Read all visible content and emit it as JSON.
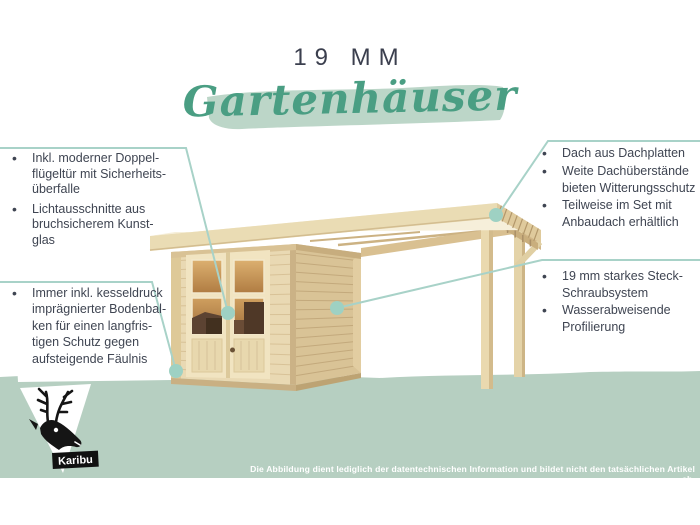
{
  "title": "19 MM",
  "headline": "Gartenhäuser",
  "logo": {
    "brand": "Karibu"
  },
  "disclaimer": "Die Abbildung dient lediglich der datentechnischen Information und bildet nicht den tatsächlichen Artikel ab.",
  "colors": {
    "headline_green": "#4a9e83",
    "brush_green": "#bcd6c8",
    "band_green": "#b6cfc1",
    "callout_line_teal": "#a8d2c8",
    "callout_dot_teal": "#9ed1c3",
    "body_text": "#3f4552",
    "title_text": "#3b3f4e",
    "wood_light": "#eadcb4",
    "wood_side": "#d9c396",
    "window_amber": "#c9965a"
  },
  "callouts": {
    "left_top": {
      "items": [
        {
          "lines": [
            "Inkl. moderner Doppel-",
            "flügeltür mit Sicherheits-",
            "überfalle"
          ]
        },
        {
          "lines": [
            "Lichtausschnitte aus",
            "bruchsicherem Kunst-",
            "glas"
          ]
        }
      ]
    },
    "left_bottom": {
      "items": [
        {
          "lines": [
            "Immer inkl. kesseldruck",
            "imprägnierter Bodenbal-",
            "ken für einen langfris-",
            "tigen Schutz gegen",
            "aufsteigende Fäulnis"
          ]
        }
      ]
    },
    "right_top": {
      "items": [
        {
          "lines": [
            "Dach aus Dachplatten"
          ]
        },
        {
          "lines": [
            "Weite Dachüberstände",
            "bieten Witterungsschutz"
          ]
        },
        {
          "lines": [
            "Teilweise im Set mit",
            "Anbaudach erhältlich"
          ]
        }
      ]
    },
    "right_middle": {
      "items": [
        {
          "lines": [
            "19 mm starkes Steck-",
            "Schraubsystem"
          ]
        },
        {
          "lines": [
            "Wasserabweisende",
            "Profilierung"
          ]
        }
      ]
    }
  }
}
